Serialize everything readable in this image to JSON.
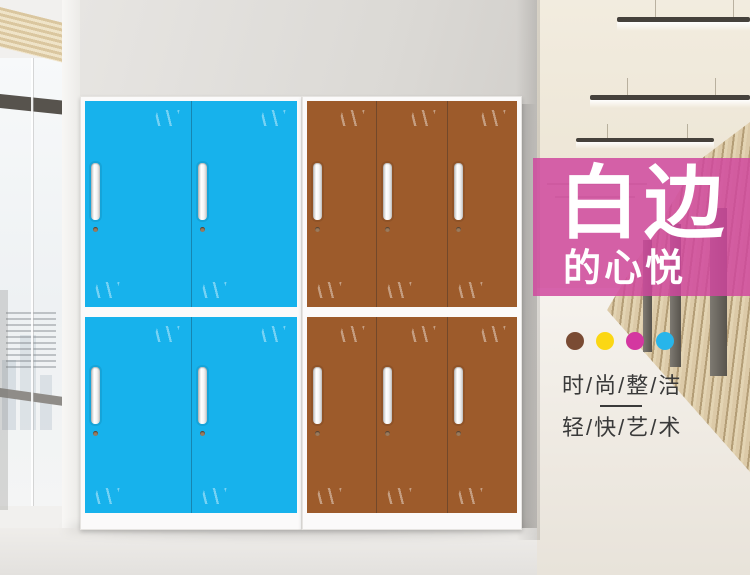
{
  "banner": {
    "title": "白边",
    "subtitle": "的心悦",
    "background_color": "#cf469d",
    "text_color": "#ffffff"
  },
  "features": {
    "dots": [
      {
        "name": "brown",
        "color": "#7a4b33"
      },
      {
        "name": "yellow",
        "color": "#fbd714"
      },
      {
        "name": "magenta",
        "color": "#d437a0"
      },
      {
        "name": "cyan",
        "color": "#27b5ea"
      }
    ],
    "line1": "时/尚/整/洁",
    "line2": "轻/快/艺/术",
    "text_color": "#3a3a3a"
  },
  "cabinets": {
    "blue": {
      "color": "#17b2ec",
      "rows": 2,
      "columns": 2,
      "frame_color": "#fbfafa"
    },
    "brown": {
      "color": "#9d5b2b",
      "rows": 2,
      "columns": 3,
      "frame_color": "#fbfafa"
    }
  },
  "scene": {
    "back_wall_color": "#dbd9d5",
    "hallway_ceiling_color": "#ece5d6",
    "wood_wall_color": "#d3bf9b",
    "floor_color": "#efece6"
  }
}
